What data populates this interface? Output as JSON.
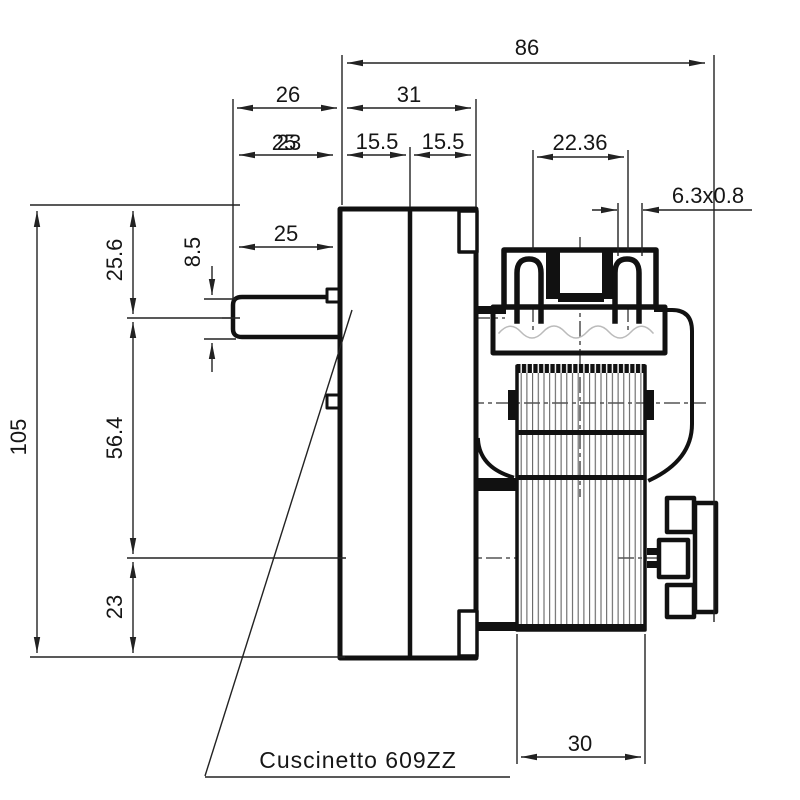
{
  "drawing": {
    "type": "technical-dimension-drawing",
    "note": {
      "bearing_label": "Cuscinetto  609ZZ"
    },
    "dimensions": {
      "overall_width": "86",
      "shaft_length": "26",
      "gearbox_width": "31",
      "shaft_dim_overlap_a": "25",
      "shaft_dim_overlap_b": "23",
      "gearbox_half_left": "15.5",
      "gearbox_half_right": "15.5",
      "terminal_spacing": "22.36",
      "terminal_size": "6.3x0.8",
      "shaft_flat_length": "25",
      "overall_height": "105",
      "top_to_shaft_axis": "25.6",
      "shaft_diameter": "8.5",
      "axis_to_lower_axis": "56.4",
      "lower_axis_to_bottom": "23",
      "motor_stack_width": "30"
    },
    "colors": {
      "outline": "#111111",
      "dimension_lines": "#222222",
      "centerlines": "#333333",
      "hatch": "#555555",
      "background": "#ffffff"
    }
  }
}
